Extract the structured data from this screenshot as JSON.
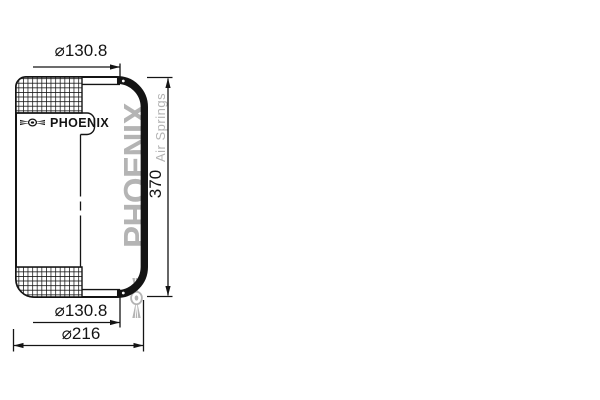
{
  "drawing": {
    "labels": {
      "top_diameter": "⌀130.8",
      "bottom_diameter": "⌀130.8",
      "outer_diameter": "⌀216",
      "height": "370"
    },
    "logo": {
      "text": "PHOENIX"
    },
    "watermark": {
      "text": "PHOENIX",
      "tagline": "Air Springs"
    },
    "colors": {
      "line": "#141414",
      "watermark": "#b4b4b4",
      "background": "#ffffff"
    }
  }
}
